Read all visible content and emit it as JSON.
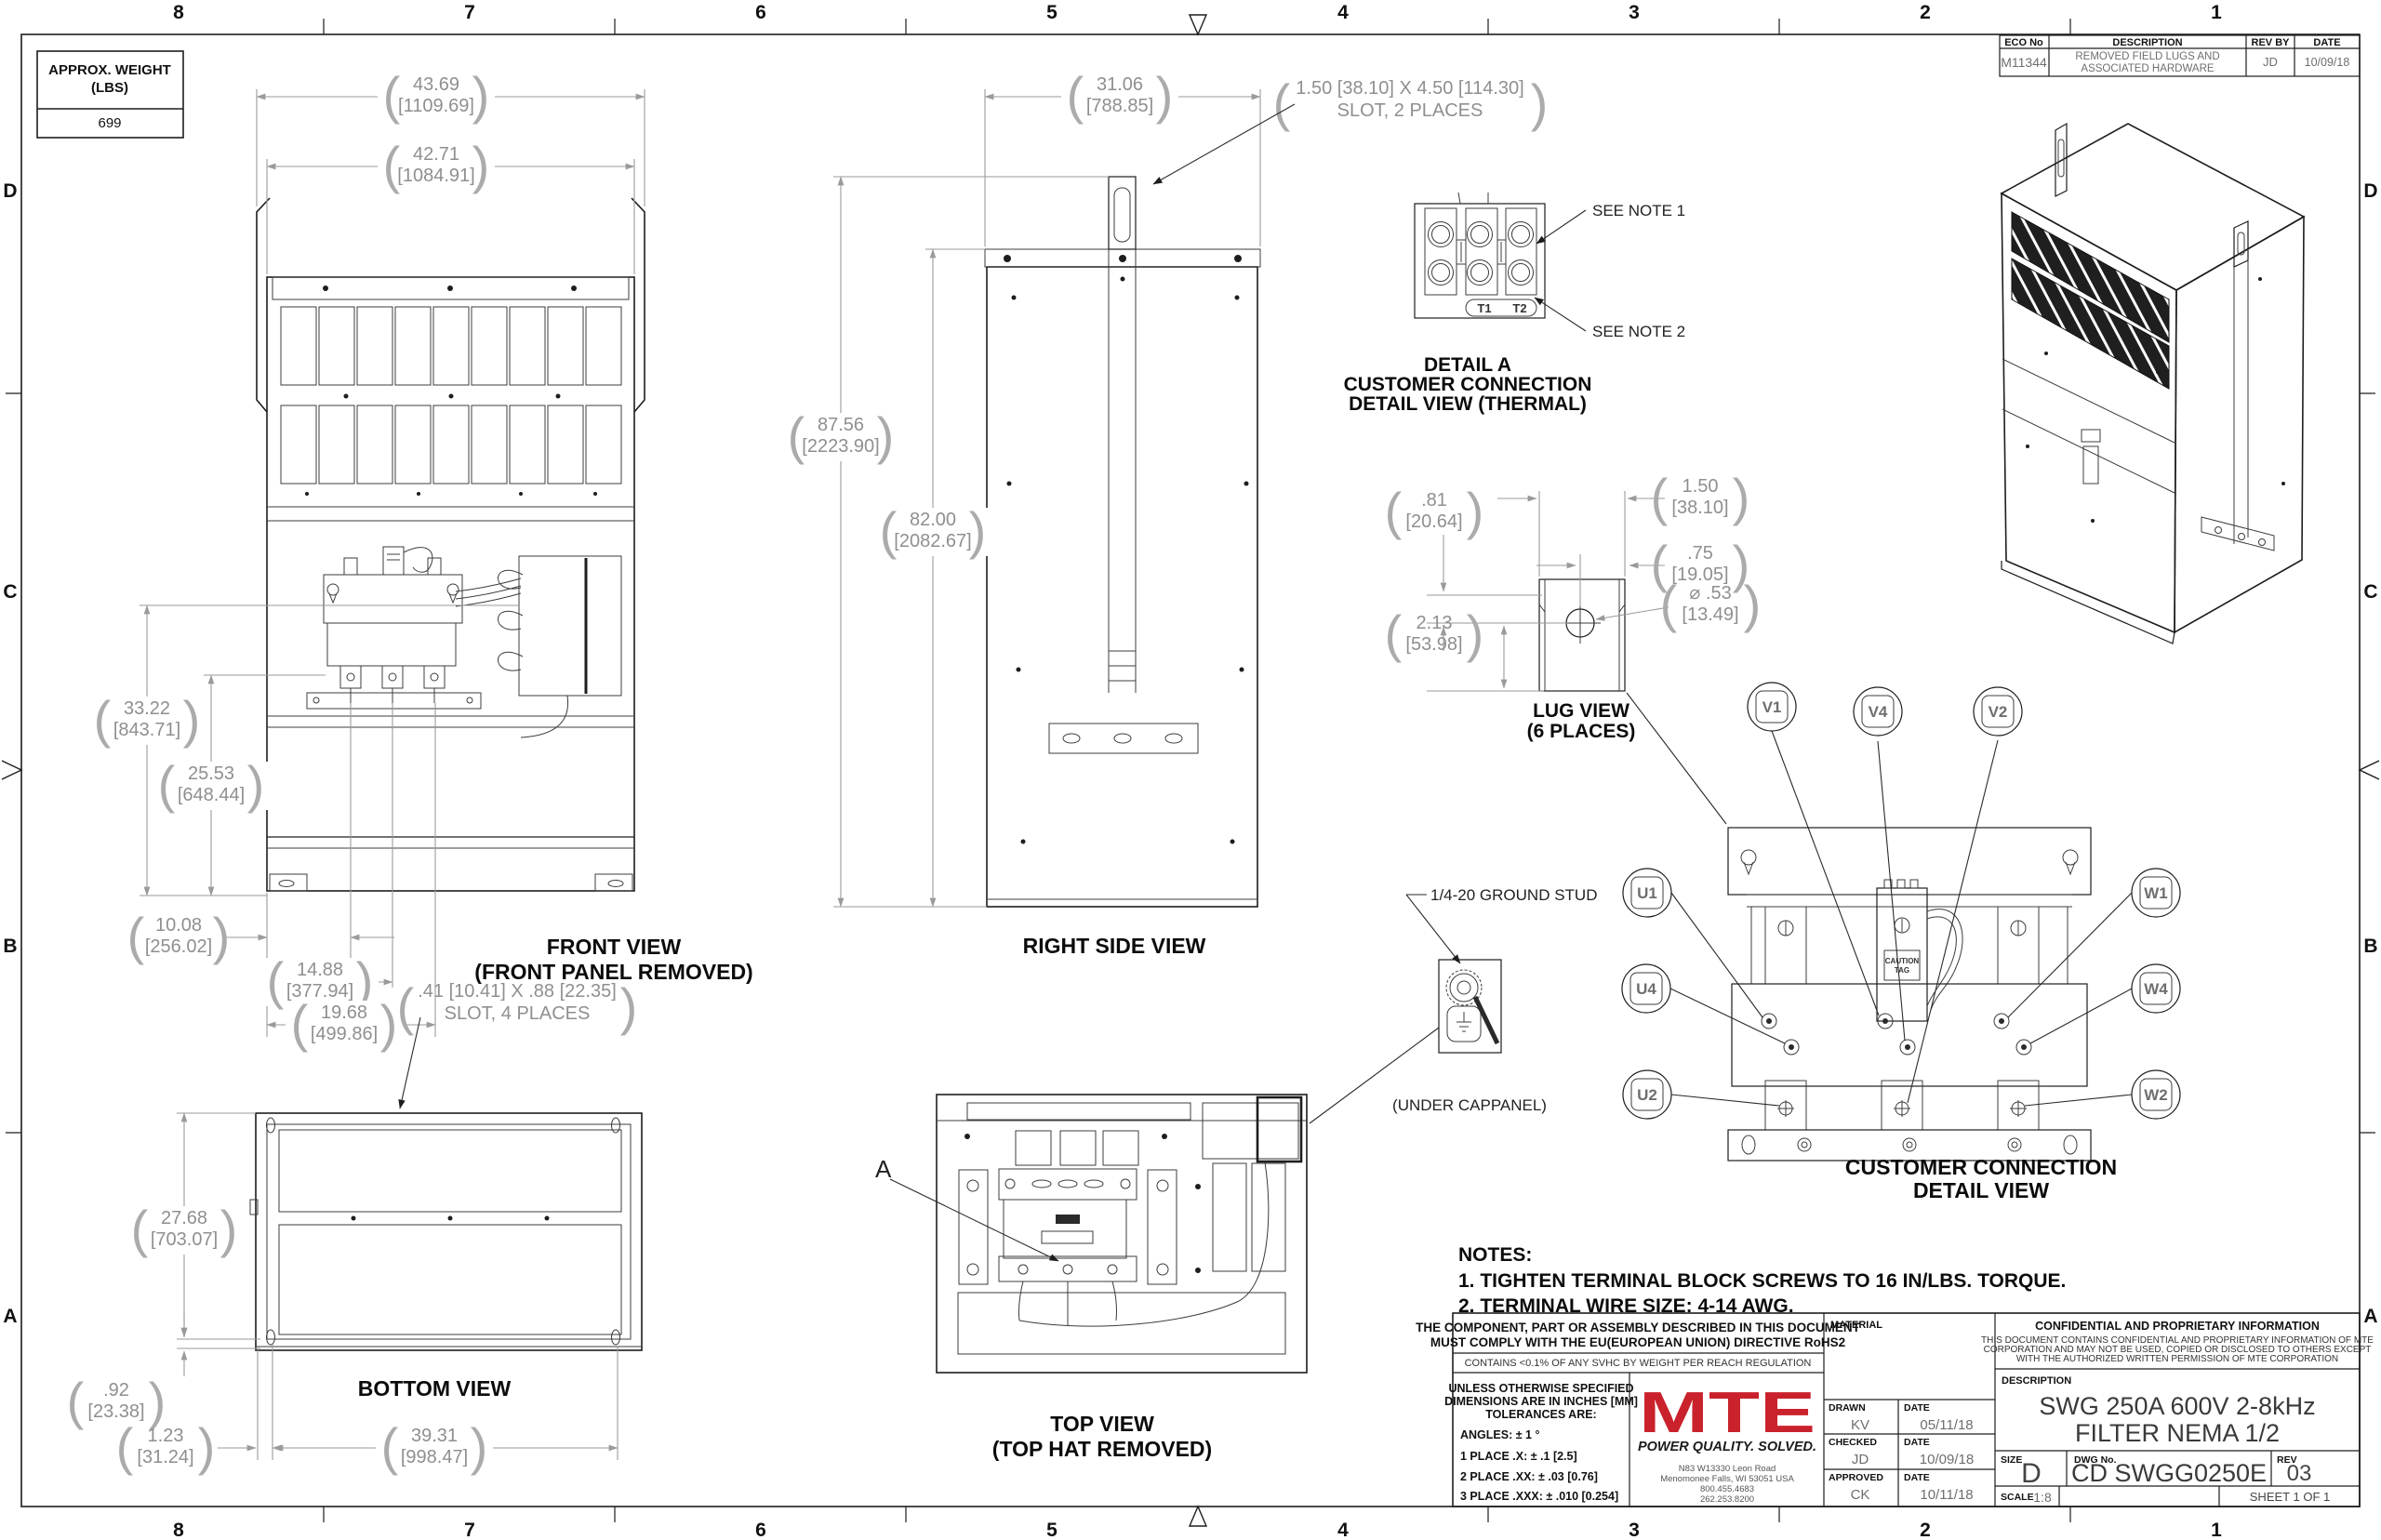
{
  "colors": {
    "logo_red": "#c9222c"
  },
  "sheet": {
    "zone_cols": [
      "8",
      "7",
      "6",
      "5",
      "4",
      "3",
      "2",
      "1"
    ],
    "zone_rows": [
      "D",
      "C",
      "B",
      "A"
    ]
  },
  "weight_box": {
    "line1": "APPROX. WEIGHT",
    "line2": "(LBS)",
    "value": "699"
  },
  "eco_table": {
    "h_eco": "ECO No",
    "h_desc": "DESCRIPTION",
    "h_rev": "REV BY",
    "h_date": "DATE",
    "eco_no": "M11344",
    "desc1": "REMOVED FIELD LUGS AND",
    "desc2": "ASSOCIATED HARDWARE",
    "rev_by": "JD",
    "date": "10/09/18"
  },
  "front_view": {
    "caption1": "FRONT VIEW",
    "caption2": "(FRONT PANEL REMOVED)",
    "dims": {
      "w_overall": {
        "in": "43.69",
        "mm": "[1109.69]"
      },
      "w_body": {
        "in": "42.71",
        "mm": "[1084.91]"
      },
      "h_mount": {
        "in": "33.22",
        "mm": "[843.71]"
      },
      "h_mid": {
        "in": "25.53",
        "mm": "[648.44]"
      },
      "x1": {
        "in": "10.08",
        "mm": "[256.02]"
      },
      "x2": {
        "in": "14.88",
        "mm": "[377.94]"
      },
      "x3": {
        "in": "19.68",
        "mm": "[499.86]"
      }
    },
    "slot_note1": ".41 [10.41] X .88 [22.35]",
    "slot_note2": "SLOT, 4 PLACES"
  },
  "right_view": {
    "caption": "RIGHT SIDE VIEW",
    "dims": {
      "w": {
        "in": "31.06",
        "mm": "[788.85]"
      },
      "h_overall": {
        "in": "87.56",
        "mm": "[2223.90]"
      },
      "h_body": {
        "in": "82.00",
        "mm": "[2082.67]"
      }
    },
    "slot_note1": "1.50 [38.10] X 4.50 [114.30]",
    "slot_note2": "SLOT, 2 PLACES"
  },
  "detail_a": {
    "note1": "SEE NOTE 1",
    "note2": "SEE NOTE 2",
    "t1": "T1",
    "t2": "T2",
    "caption1": "DETAIL A",
    "caption2": "CUSTOMER CONNECTION",
    "caption3": "DETAIL VIEW (THERMAL)"
  },
  "lug_view": {
    "caption1": "LUG VIEW",
    "caption2": "(6 PLACES)",
    "dims": {
      "d81": {
        "in": ".81",
        "mm": "[20.64]"
      },
      "d150": {
        "in": "1.50",
        "mm": "[38.10]"
      },
      "d75": {
        "in": ".75",
        "mm": "[19.05]"
      },
      "d213": {
        "in": "2.13",
        "mm": "[53.98]"
      },
      "dia": {
        "in": "⌀ .53",
        "mm": "[13.49]"
      }
    }
  },
  "connection_view": {
    "caption1": "CUSTOMER CONNECTION",
    "caption2": "DETAIL VIEW",
    "balloons": {
      "u1": "U1",
      "u4": "U4",
      "u2": "U2",
      "v1": "V1",
      "v4": "V4",
      "v2": "V2",
      "w1": "W1",
      "w4": "W4",
      "w2": "W2"
    },
    "caution1": "CAUTION",
    "caution2": "TAG"
  },
  "ground_stud": {
    "label": "1/4-20 GROUND STUD",
    "sub": "(UNDER CAPPANEL)"
  },
  "top_view": {
    "caption1": "TO​P VIEW",
    "caption2": "(TOP HAT REMOVED)",
    "detail_label": "A"
  },
  "bottom_view": {
    "caption": "BOTTOM VIEW",
    "dims": {
      "h": {
        "in": "27.68",
        "mm": "[703.07]"
      },
      "o1": {
        "in": ".92",
        "mm": "[23.38]"
      },
      "o2": {
        "in": "1.23",
        "mm": "[31.24]"
      },
      "w": {
        "in": "39.31",
        "mm": "[998.47]"
      }
    }
  },
  "notes": {
    "title": "NOTES:",
    "n1": "1.  TIGHTEN TERMINAL BLOCK SCREWS TO 16 IN/LBS. TORQUE.",
    "n2": "2.  TERMINAL WIRE SIZE: 4-14 AWG."
  },
  "title_block": {
    "compliance1": "THE COMPONENT, PART OR ASSEMBLY DESCRIBED IN THIS DOCUMENT",
    "compliance2": "MUST COMPLY WITH THE EU(EUROPEAN UNION) DIRECTIVE RoHS2",
    "reach": "CONTAINS <0.1% OF ANY SVHC BY WEIGHT PER REACH REGULATION",
    "tol1": "UNLESS OTHERWISE SPECIFIED",
    "tol2": "DIMENSIONS ARE IN INCHES [MM]",
    "tol3": "TOLERANCES ARE:",
    "tol_angles": "ANGLES: ± 1 °",
    "tol_x": "1 PLACE .X: ± .1 [2.5]",
    "tol_xx": "2 PLACE .XX: ± .03 [0.76]",
    "tol_xxx": "3 PLACE .XXX: ± .010 [0.254]",
    "logo": "MTE",
    "tagline": "POWER QUALITY. SOLVED.",
    "addr1": "N83 W13330 Leon Road",
    "addr2": "Menomonee Falls, WI 53051 USA",
    "addr3": "800.455.4683",
    "addr4": "262.253.8200",
    "material_label": "MATERIAL",
    "drawn_label": "DRAWN",
    "drawn": "KV",
    "drawn_date_label": "DATE",
    "drawn_date": "05/11/18",
    "checked_label": "CHECKED",
    "checked": "JD",
    "checked_date_label": "DATE",
    "checked_date": "10/09/18",
    "approved_label": "APPROVED",
    "approved": "CK",
    "approved_date_label": "DATE",
    "approved_date": "10/11/18",
    "conf_title": "CONFIDENTIAL AND PROPRIETARY INFORMATION",
    "conf1": "THIS DOCUMENT CONTAINS CONFIDENTIAL AND PROPRIETARY INFORMATION OF MTE",
    "conf2": "CORPORATION AND MAY NOT BE USED, COPIED OR DISCLOSED TO OTHERS EXCEPT",
    "conf3": "WITH THE AUTHORIZED WRITTEN PERMISSION OF MTE CORPORATION",
    "desc_label": "DESCRIPTION",
    "desc1": "SWG 250A 600V 2-8kHz",
    "desc2": "FILTER NEMA 1/2",
    "size_label": "SIZE",
    "size": "D",
    "dwg_label": "DWG No.",
    "dwg_no": "CD SWGG0250E",
    "rev_label": "REV",
    "rev": "03",
    "scale_label": "SCALE",
    "scale": "1:8",
    "sheet": "SHEET 1  OF 1"
  }
}
